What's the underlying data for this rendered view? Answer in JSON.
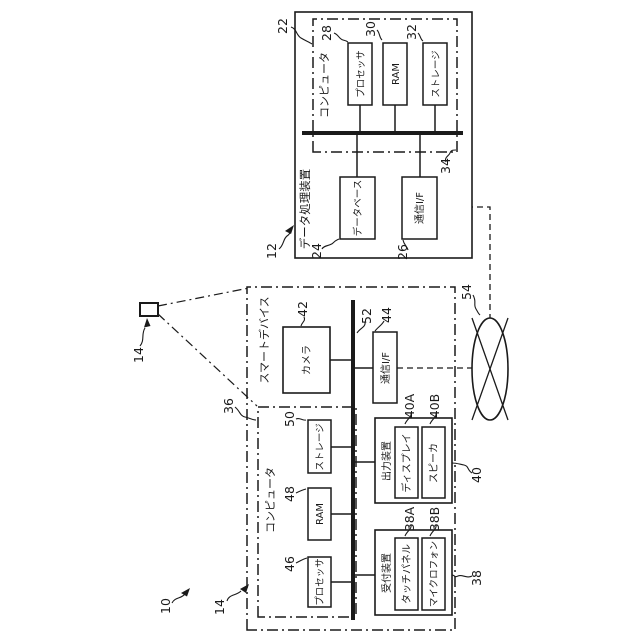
{
  "figure_type": "patent-block-diagram",
  "orientation": "rotated-90",
  "colors": {
    "ink": "#1a1a1a",
    "background": "#ffffff"
  },
  "system": {
    "ref": "10"
  },
  "smart_device": {
    "label": "スマートデバイス",
    "ref": "14",
    "computer": {
      "label": "コンピュータ",
      "ref": "36",
      "processor": {
        "label": "プロセッサ",
        "ref": "46"
      },
      "ram": {
        "label": "RAM",
        "ref": "48"
      },
      "storage": {
        "label": "ストレージ",
        "ref": "50"
      }
    },
    "bus": {
      "ref": "52"
    },
    "camera": {
      "label": "カメラ",
      "ref": "42"
    },
    "comm_if": {
      "label": "通信I/F",
      "ref": "44"
    },
    "output_device": {
      "label": "出力装置",
      "ref": "40",
      "display": {
        "label": "ディスプレイ",
        "ref": "40A"
      },
      "speaker": {
        "label": "スピーカ",
        "ref": "40B"
      }
    },
    "reception_device": {
      "label": "受付装置",
      "ref": "38",
      "touch_panel": {
        "label": "タッチパネル",
        "ref": "38A"
      },
      "microphone": {
        "label": "マイクロフォン",
        "ref": "38B"
      }
    }
  },
  "data_processing_device": {
    "label": "データ処理装置",
    "ref": "12",
    "computer": {
      "label": "コンピュータ",
      "ref": "22",
      "processor": {
        "label": "プロセッサ",
        "ref": "28"
      },
      "ram": {
        "label": "RAM",
        "ref": "30"
      },
      "storage": {
        "label": "ストレージ",
        "ref": "32"
      }
    },
    "bus": {
      "ref": "34"
    },
    "database": {
      "label": "データベース",
      "ref": "24"
    },
    "comm_if": {
      "label": "通信I/F",
      "ref": "26"
    }
  },
  "network": {
    "ref": "54"
  }
}
